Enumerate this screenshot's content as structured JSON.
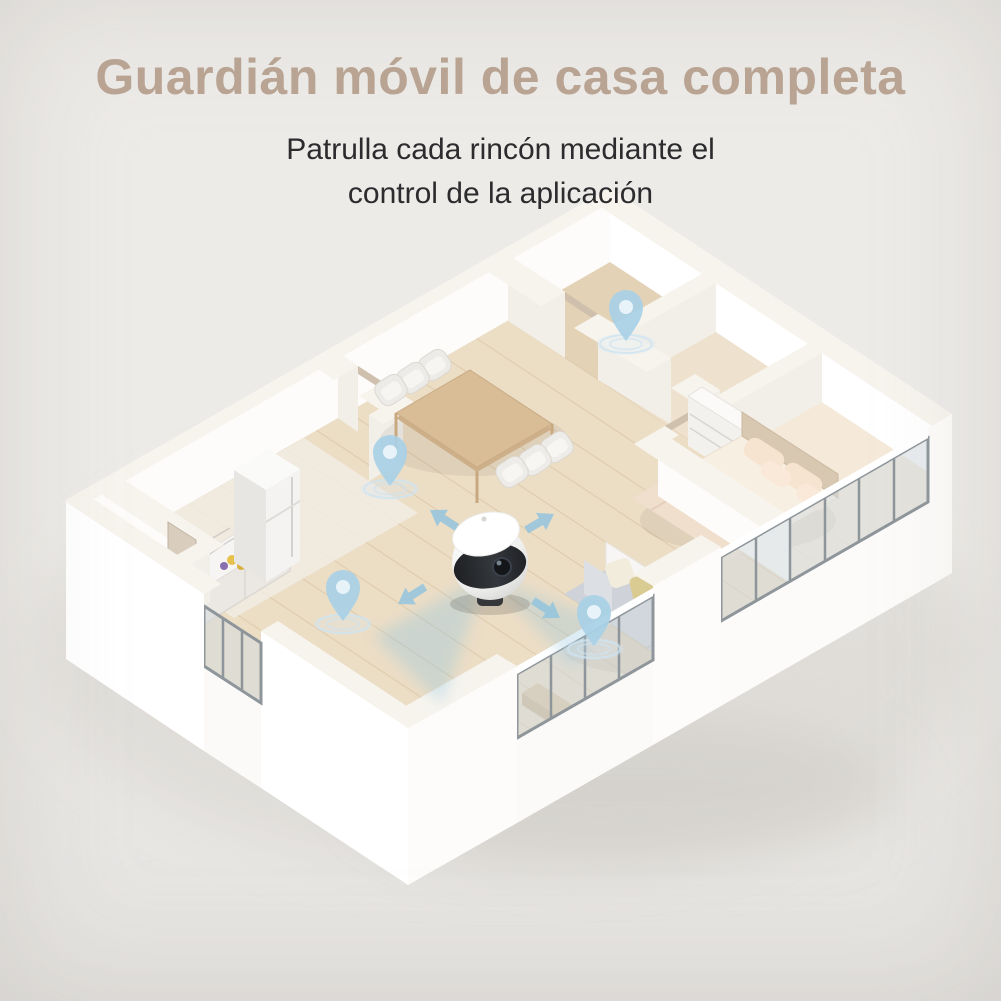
{
  "header": {
    "title": "Guardián móvil de casa completa",
    "subtitle_line1": "Patrulla cada rincón mediante el",
    "subtitle_line2": "control de la aplicación"
  },
  "colors": {
    "page_bg": "#edebe8",
    "page_bg_bottom": "#e5e3e0",
    "title": "#b9a493",
    "subtitle": "#2c2c2e",
    "wall_white": "#fdfcfa",
    "wall_shade": "#f2efe9",
    "wall_top": "#f7f4ee",
    "wall_lit": "#ffffff",
    "floor_wood": "#ecddc5",
    "plank_line": "#d8c19e",
    "glass": "#d3dbdf",
    "glass_frame": "#8f969b",
    "accent_blue": "#8ec3de",
    "pin_fill": "#a8d0e6",
    "robot_dark": "#2a2c30",
    "sofa_gray": "#cfd3d9",
    "pillow_tan": "#d9cb92",
    "bed_linen": "#f8efe3",
    "wood_furniture": "#d9bd97"
  },
  "scene": {
    "type": "isometric-apartment-floorplan-render",
    "robot": "home-security-patrol-robot",
    "markers": [
      "location-pin-hallway",
      "location-pin-dining-area",
      "location-pin-kitchen-corridor",
      "location-pin-sofa-area"
    ],
    "arrows": [
      "patrol-arrow-up-left",
      "patrol-arrow-up-right",
      "patrol-arrow-down-left",
      "patrol-arrow-down-right"
    ],
    "rooms": [
      "hallway",
      "bathroom",
      "bedroom",
      "living-dining-room",
      "kitchen",
      "balcony"
    ],
    "furniture": [
      "dining-table",
      "dining-chairs",
      "sofa",
      "bed",
      "dresser",
      "kitchen-counter",
      "refrigerator",
      "stove",
      "bench"
    ]
  }
}
